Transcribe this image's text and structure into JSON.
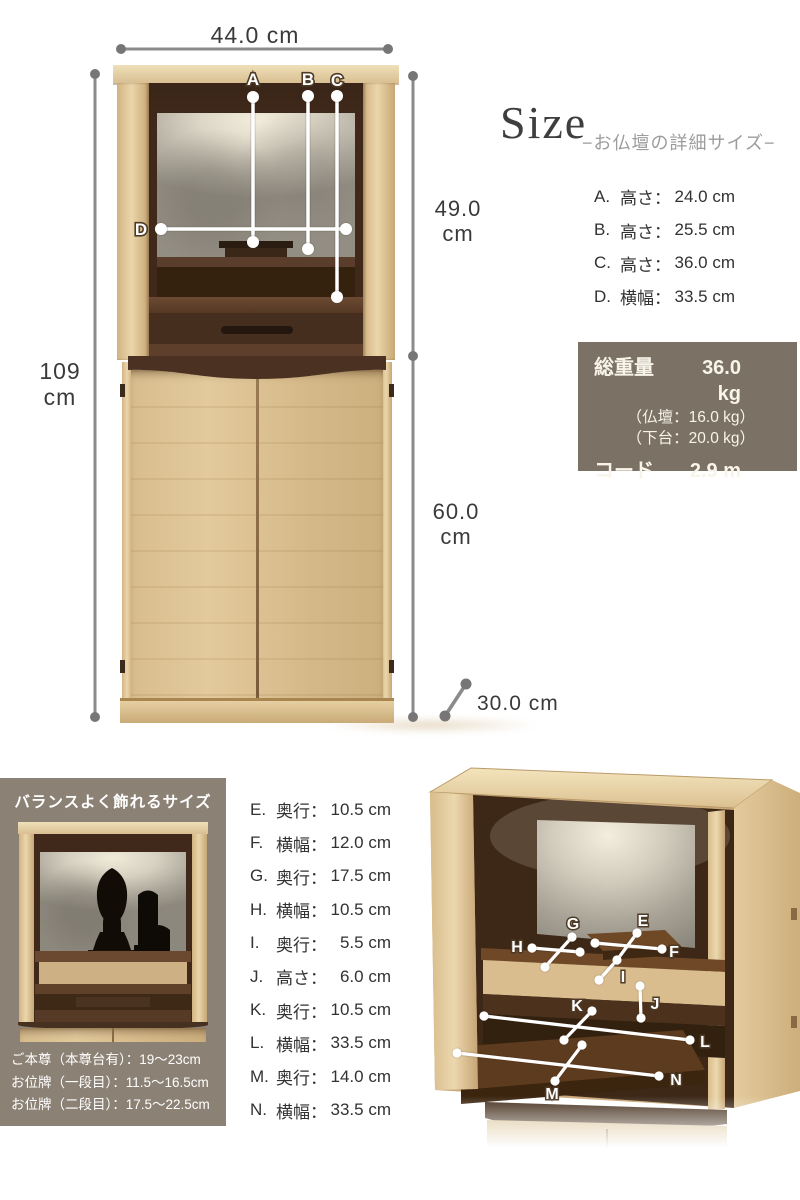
{
  "title_block": {
    "title": "Size",
    "subtitle": "−お仏壇の詳細サイズ−"
  },
  "front_dims": {
    "width": "44.0 cm",
    "total_height": [
      "109",
      "cm"
    ],
    "upper_height": [
      "49.0",
      "cm"
    ],
    "lower_height": [
      "60.0",
      "cm"
    ],
    "depth": "30.0 cm"
  },
  "front_labels": [
    "A",
    "B",
    "C",
    "D"
  ],
  "detail_labels": [
    "E",
    "F",
    "G",
    "H",
    "I",
    "J",
    "K",
    "L",
    "M",
    "N"
  ],
  "measurements_front": [
    {
      "key": "A.",
      "name": "高さ：",
      "value": "24.0 cm"
    },
    {
      "key": "B.",
      "name": "高さ：",
      "value": "25.5 cm"
    },
    {
      "key": "C.",
      "name": "高さ：",
      "value": "36.0 cm"
    },
    {
      "key": "D.",
      "name": "横幅：",
      "value": "33.5 cm"
    }
  ],
  "measurements_detail": [
    {
      "key": "E.",
      "name": "奥行：",
      "value": "10.5 cm"
    },
    {
      "key": "F.",
      "name": "横幅：",
      "value": "12.0 cm"
    },
    {
      "key": "G.",
      "name": "奥行：",
      "value": "17.5 cm"
    },
    {
      "key": "H.",
      "name": "横幅：",
      "value": "10.5 cm"
    },
    {
      "key": "I.",
      "name": "奥行：",
      "value": "5.5 cm"
    },
    {
      "key": "J.",
      "name": "高さ：",
      "value": "6.0 cm"
    },
    {
      "key": "K.",
      "name": "奥行：",
      "value": "10.5 cm"
    },
    {
      "key": "L.",
      "name": "横幅：",
      "value": "33.5 cm"
    },
    {
      "key": "M.",
      "name": "奥行：",
      "value": "14.0 cm"
    },
    {
      "key": "N.",
      "name": "横幅：",
      "value": "33.5 cm"
    }
  ],
  "spec_box": {
    "weight_label": "総重量",
    "weight_value": "36.0 kg",
    "weight_detail_1": "（仏壇：16.0 kg）",
    "weight_detail_2": "（下台：20.0 kg）",
    "cord_label": "コード",
    "cord_value": "2.9 m"
  },
  "balance_panel": {
    "title": "バランスよく飾れるサイズ",
    "lines": [
      "ご本尊（本尊台有）：19～23cm",
      "お位牌（一段目）：11.5～16.5cm",
      "お位牌（二段目）：17.5～22.5cm"
    ]
  },
  "colors": {
    "wood_light": "#ddc396",
    "wood_dark": "#4a3121",
    "back_panel_silver": "#b5b1a6",
    "spec_box_bg": "#7b7164",
    "balance_bg": "#8c8175",
    "dim_line": "#8b8b8b",
    "text": "#333333",
    "subtitle": "#9c9c9c"
  }
}
